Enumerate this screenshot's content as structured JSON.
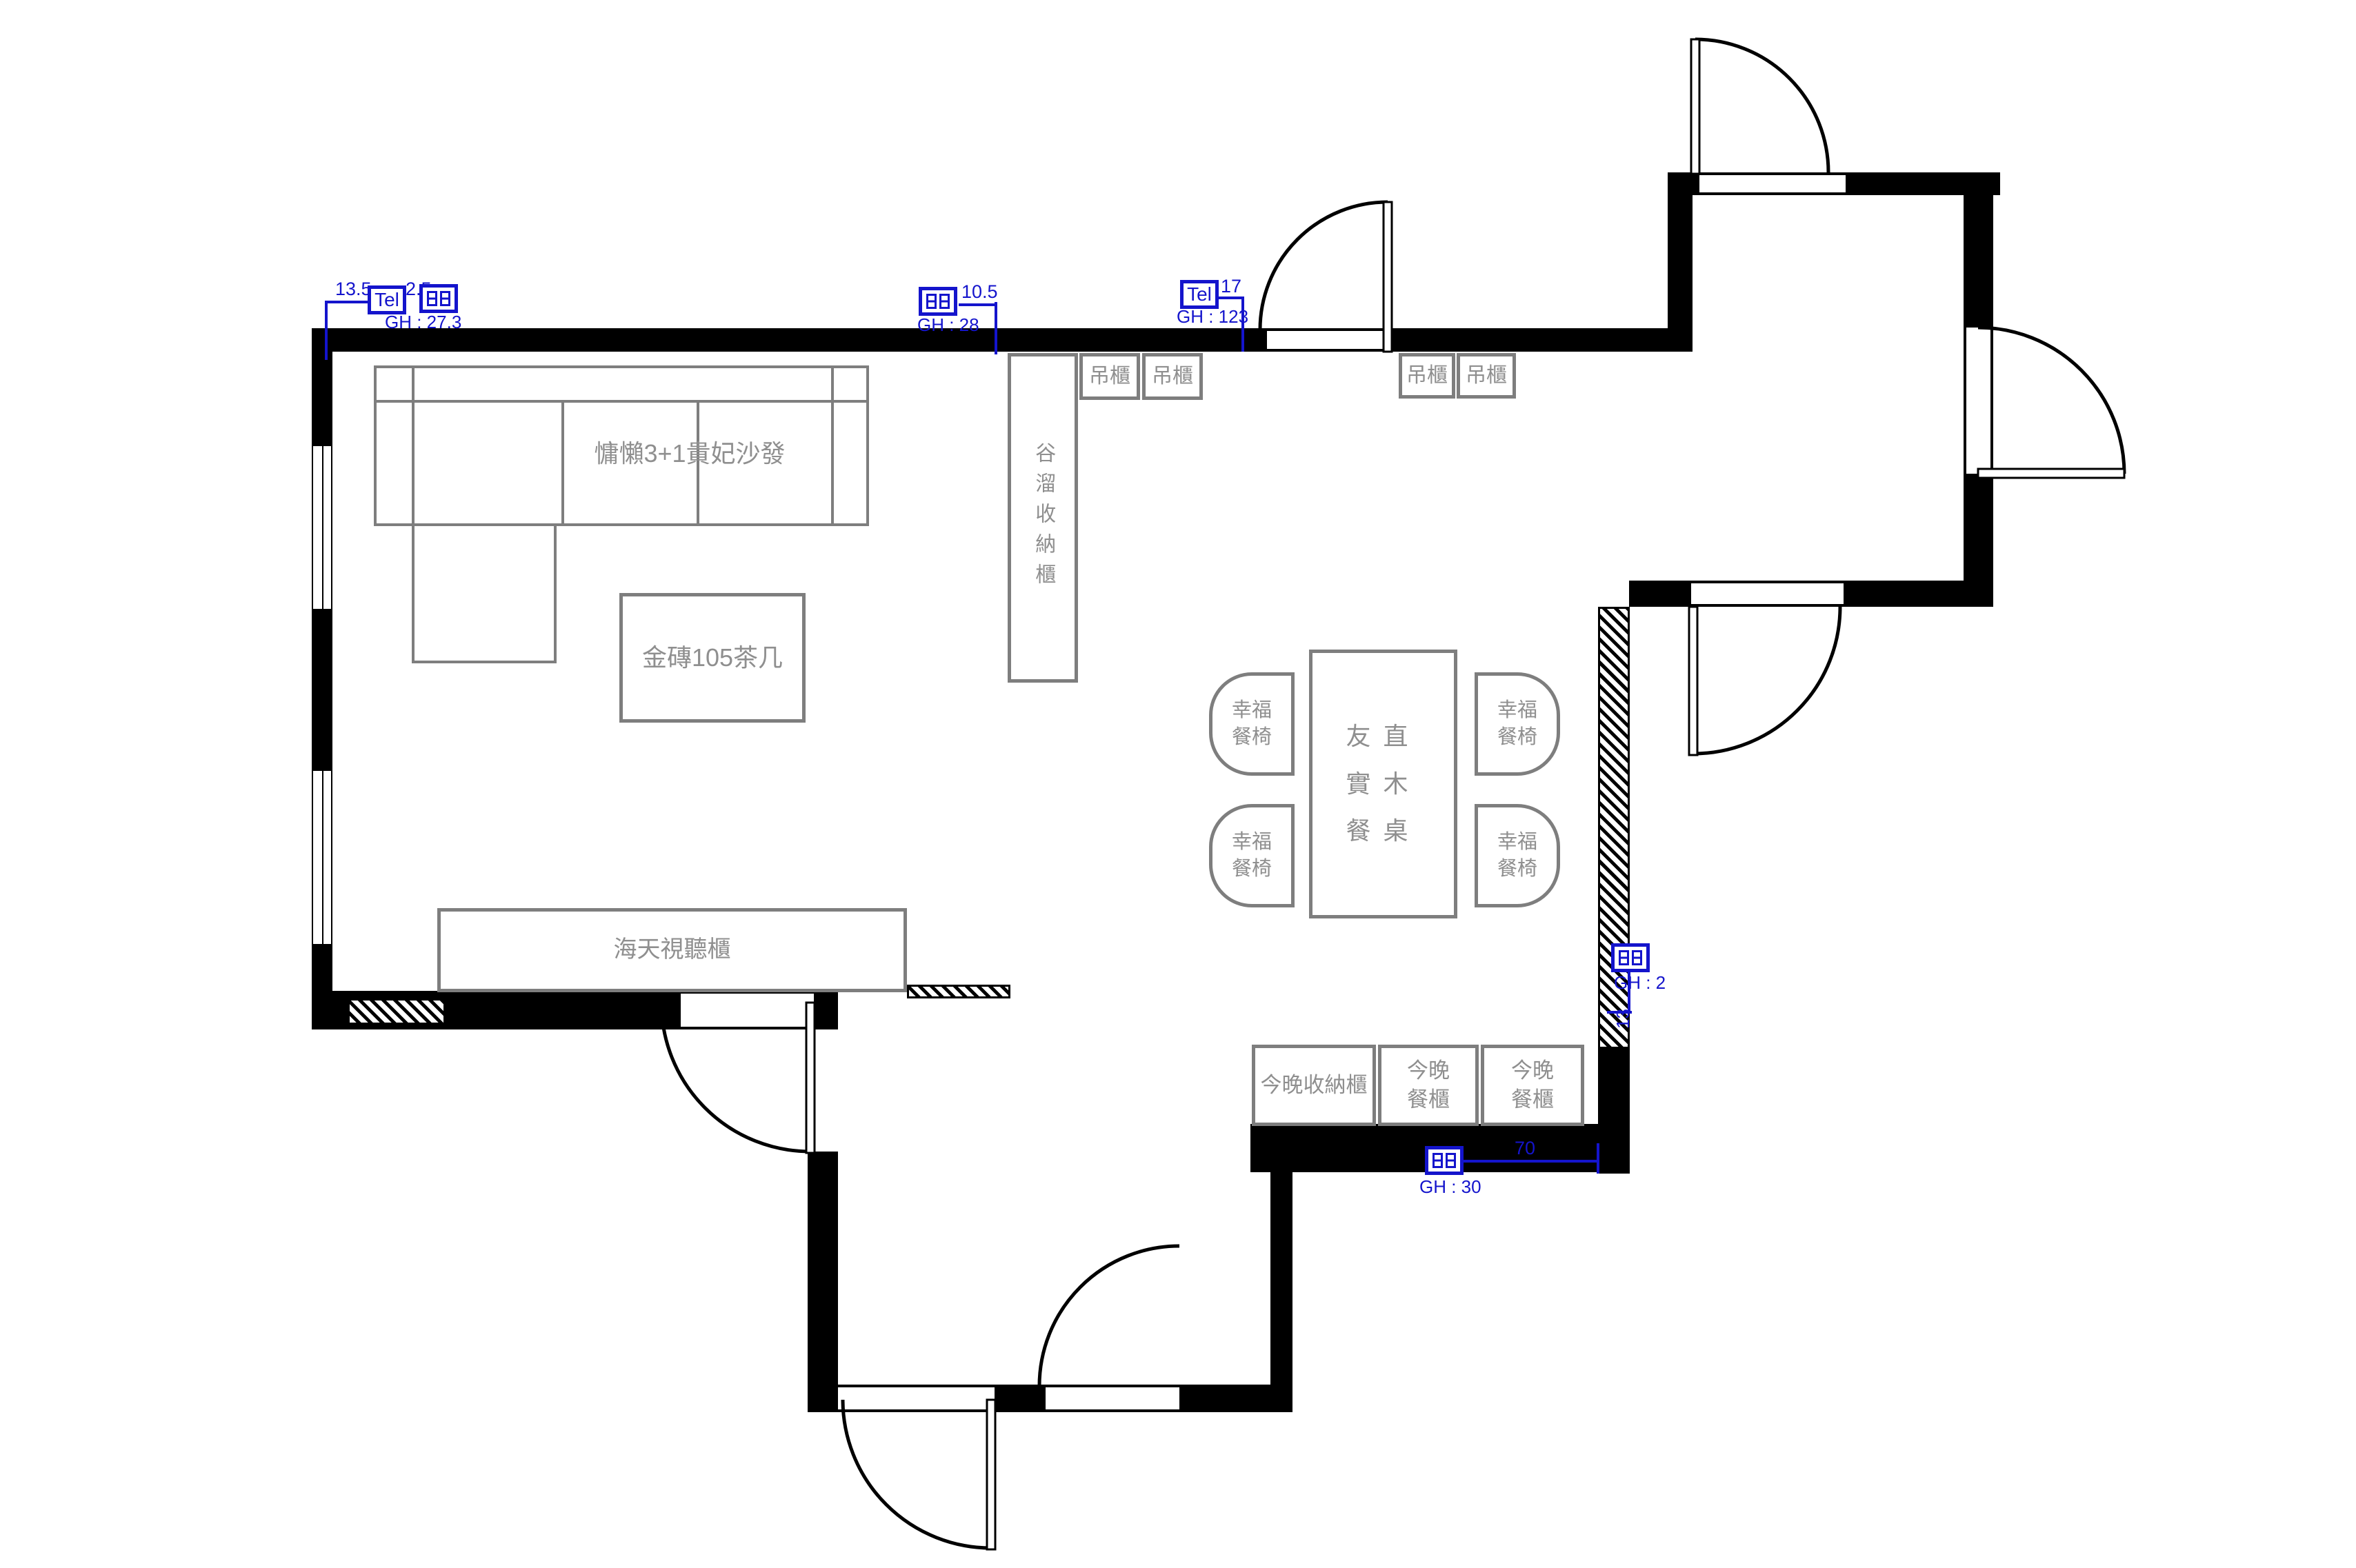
{
  "colors": {
    "wall": "#000000",
    "furniture_line": "#7e7e7e",
    "label_text": "#8f8f8f",
    "annotation_blue": "#1414cc",
    "background": "#ffffff"
  },
  "furniture": {
    "sofa_label": "慵懶3+1貴妃沙發",
    "coffee_table_label": "金磚105茶几",
    "tv_cabinet_label": "海天視聽櫃",
    "storage_tower_label": "谷溜收納櫃",
    "hanging_cabinet_label": "吊櫃",
    "dining_table_lines": [
      "友直",
      "實木",
      "餐桌"
    ],
    "dining_chair_lines": [
      "幸福",
      "餐椅"
    ],
    "bottom_storage_label": "今晚收納櫃",
    "bottom_dining_cabinet_lines": [
      "今晚",
      "餐櫃"
    ]
  },
  "annotations": {
    "top_left": {
      "dim_left": "13.5",
      "tel": "Tel",
      "dim_right": "2.5",
      "gh": "GH : 27.3"
    },
    "top_mid": {
      "dim": "10.5",
      "gh": "GH : 28"
    },
    "top_door": {
      "tel": "Tel",
      "dim": "17",
      "gh": "GH : 123"
    },
    "right_mid": {
      "gh": "GH : 2",
      "dim": "13"
    },
    "bottom": {
      "dim": "70",
      "gh": "GH : 30"
    }
  }
}
